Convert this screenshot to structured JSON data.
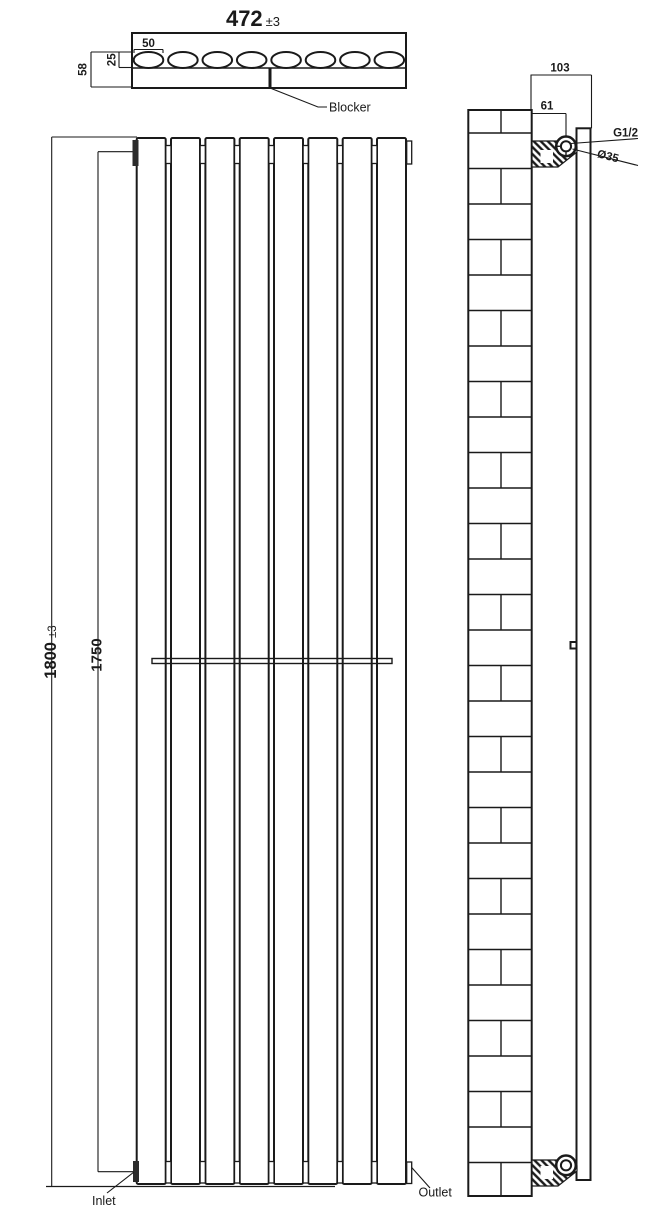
{
  "drawing": {
    "top_view": {
      "width_value": "472",
      "width_tolerance": "±3",
      "column_pitch": "50",
      "column_depth": "25",
      "total_depth": "58",
      "blocker_label": "Blocker",
      "column_count": 8
    },
    "front_view": {
      "height_value": "1800",
      "height_tolerance": "±3",
      "pipe_centres": "1750",
      "inlet_label": "Inlet",
      "outlet_label": "Outlet",
      "panel_count": 8
    },
    "side_view": {
      "depth_from_wall": "103",
      "bracket_projection": "61",
      "thread_size": "G1/2",
      "connection_diameter": "Ø35"
    },
    "colors": {
      "line": "#1a1a1a",
      "background": "#ffffff"
    }
  }
}
